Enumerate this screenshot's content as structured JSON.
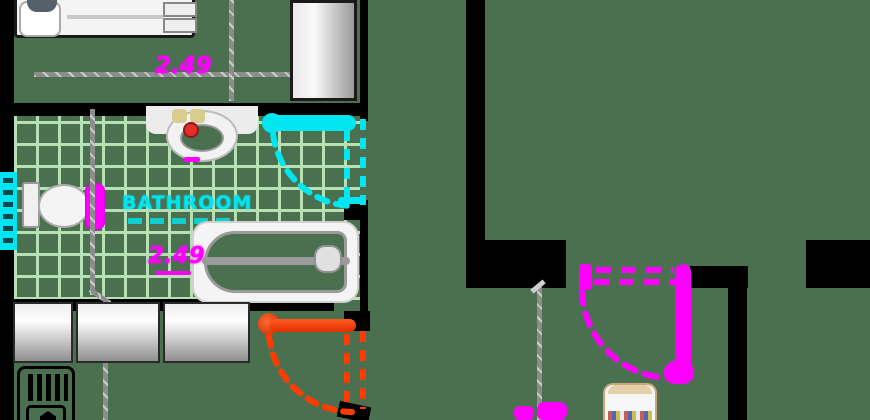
{
  "scene": {
    "type": "apartment-floor-plan",
    "width_px": 870,
    "height_px": 420
  },
  "labels": {
    "bathroom_room_label": "BATHROOM",
    "bedroom_dimension": "2.49",
    "bathtub_dimension": "2.49"
  },
  "colors": {
    "bg": "#4a7050",
    "wall": "#000000",
    "tile": "#c9f5c6",
    "magenta": "#ff00ff",
    "cyan": "#00e6f0",
    "orange": "#ff3c00",
    "dim": "#8c8c8c",
    "fixture": "#f2f2f2"
  },
  "rooms": [
    {
      "name": "bedroom",
      "position": "top-left"
    },
    {
      "name": "bathroom",
      "position": "middle-left",
      "floor": "tiled"
    },
    {
      "name": "closet",
      "position": "bottom-left"
    },
    {
      "name": "adjacent-room",
      "position": "right"
    }
  ],
  "fixtures": [
    {
      "name": "bed-icon"
    },
    {
      "name": "cabinet-icon"
    },
    {
      "name": "washbasin-icon"
    },
    {
      "name": "toilet-icon"
    },
    {
      "name": "bathtub-icon"
    },
    {
      "name": "window-icon"
    },
    {
      "name": "wardrobe-doors-icon"
    },
    {
      "name": "radiator-icon"
    },
    {
      "name": "stool-icon"
    }
  ],
  "doors": [
    {
      "name": "bathroom-door",
      "color": "cyan",
      "style": "dashed-swing-arc"
    },
    {
      "name": "closet-door",
      "color": "orange",
      "style": "dashed-swing-arc"
    },
    {
      "name": "adjacent-room-door",
      "color": "magenta",
      "style": "dashed-swing-arc"
    }
  ]
}
